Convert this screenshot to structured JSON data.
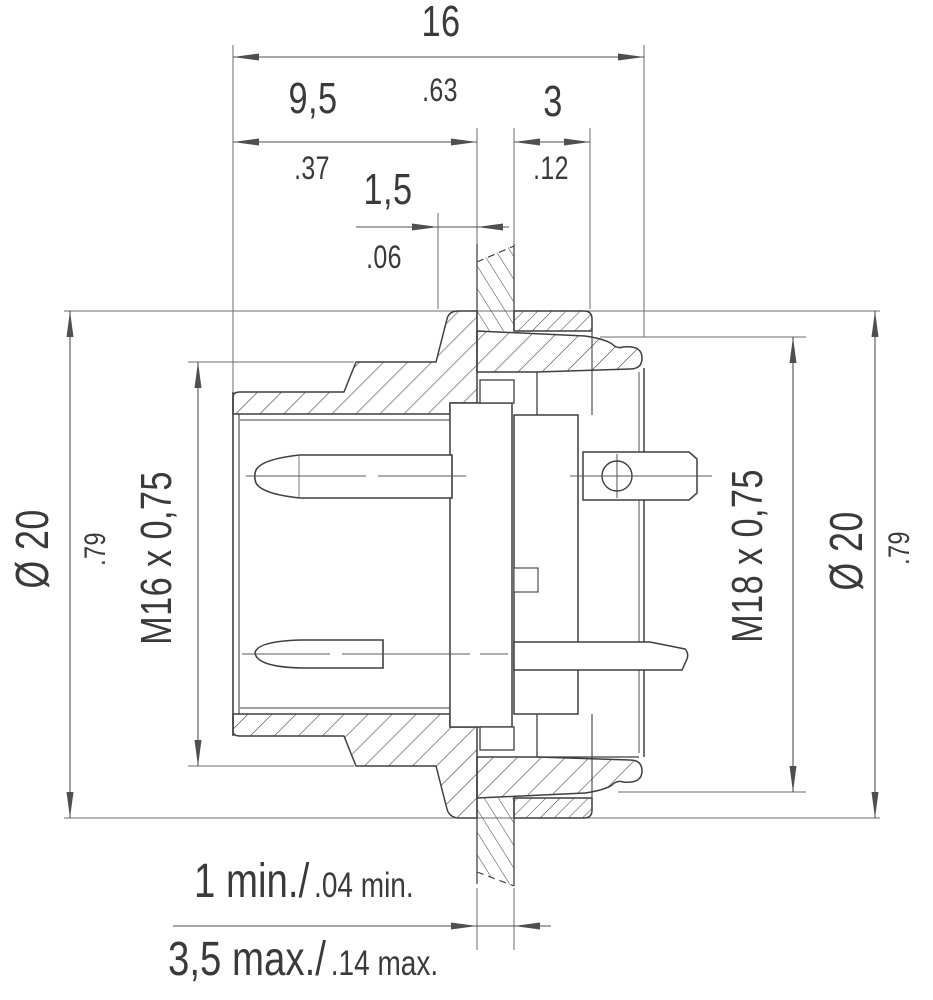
{
  "colors": {
    "outline": "#414141",
    "dim_line": "#585858",
    "text": "#3a3a3a",
    "background": "#ffffff"
  },
  "dimensions": {
    "overall": {
      "metric": "16",
      "inch": ".63"
    },
    "front_length": {
      "metric": "9,5",
      "inch": ".37"
    },
    "flange_gap": {
      "metric": "1,5",
      "inch": ".06"
    },
    "rear_flange_thickness": {
      "metric": "3",
      "inch": ".12"
    },
    "left_diameter": {
      "metric": "Ø 20",
      "inch": ".79"
    },
    "right_diameter": {
      "metric": "Ø 20",
      "inch": ".79"
    },
    "front_thread": "M16 x 0,75",
    "rear_thread": "M18 x 0,75"
  },
  "panel_note": {
    "min_metric": "1 min./",
    "min_inch": ".04 min.",
    "max_metric": "3,5 max./",
    "max_inch": ".14 max."
  }
}
